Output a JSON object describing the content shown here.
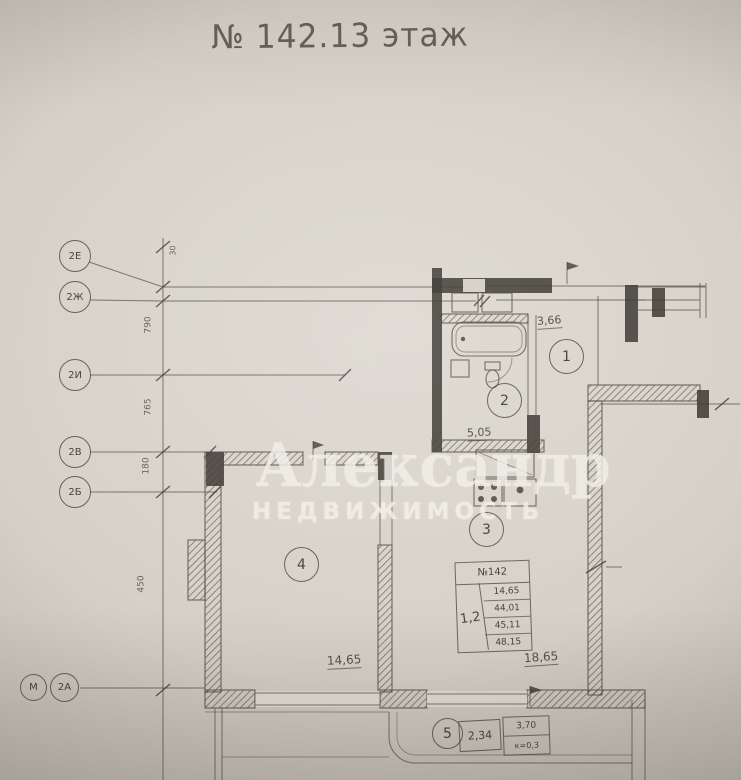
{
  "colors": {
    "paper": "#d6d1c7",
    "ink": "#4e4941",
    "wall": "#3d3932",
    "watermark": "#f2efe8"
  },
  "title": "№ 142.13 этаж",
  "watermark": {
    "line1": "Александр",
    "line2": "НЕДВИЖИМОСТЬ"
  },
  "axis_markers": {
    "left": [
      {
        "label": "2Е"
      },
      {
        "label": "2Ж"
      },
      {
        "label": "2И"
      },
      {
        "label": "2В"
      },
      {
        "label": "2Б"
      }
    ],
    "bottom": [
      {
        "label": "М"
      },
      {
        "label": "2А"
      }
    ]
  },
  "rooms": [
    {
      "number": "1"
    },
    {
      "number": "2"
    },
    {
      "number": "3"
    },
    {
      "number": "4"
    },
    {
      "number": "5"
    }
  ],
  "area_labels": {
    "room1": "3,66",
    "room2": "5,05",
    "room3": "18,65",
    "room4": "14,65",
    "room5": "2,34"
  },
  "loggia_note": {
    "area": "3,70",
    "coef": "к=0,3"
  },
  "info_table": {
    "header": "№142",
    "rooms": "1,2",
    "values": [
      "14,65",
      "44,01",
      "45,11",
      "48,15"
    ]
  },
  "dim_labels": {
    "v1": "30",
    "v2": "790",
    "v3": "765",
    "v4": "180",
    "v5": "450"
  }
}
